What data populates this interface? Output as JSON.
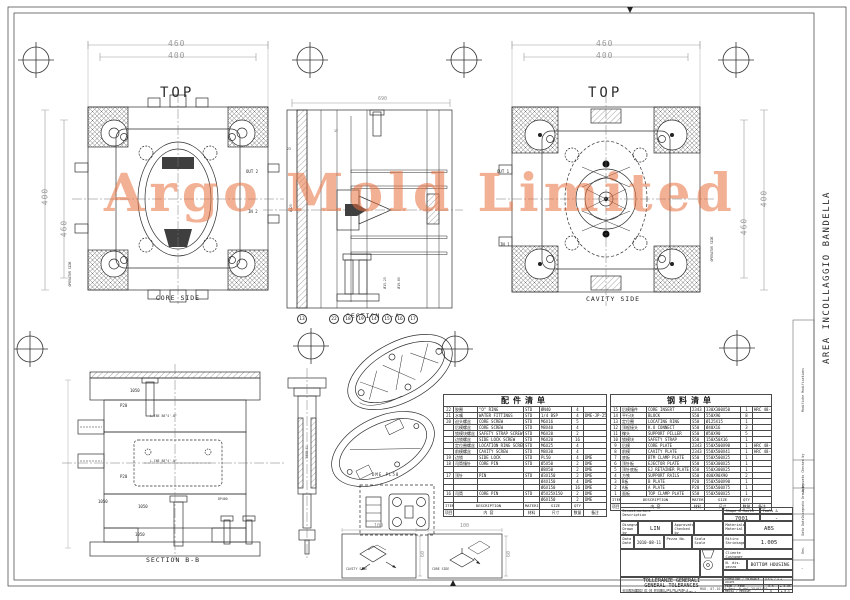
{
  "watermark": {
    "text": "Argo Mold Limited",
    "color": "#e8703f"
  },
  "sheet": {
    "side_note": "AREA INCOLLAGGIO BANDELLA",
    "registration_icon": "crosshair-target",
    "projection_icon": "first-angle-projection"
  },
  "views": {
    "core_top": {
      "title": "TOP",
      "caption": "CORE SIDE",
      "dim_top_outer": "460",
      "dim_top_inner": "400",
      "dim_left_outer": "400",
      "dim_left_inner": "460",
      "out_label": "OUT 2",
      "in_label": "IN 2",
      "operator": "OPERATOR SIDE"
    },
    "cavity_top": {
      "title": "TOP",
      "caption": "CAVITY SIDE",
      "dim_top_outer": "460",
      "dim_top_inner": "400",
      "dim_right_outer": "400",
      "dim_right_inner": "460",
      "out_label": "OUT 1",
      "in_label": "IN 1",
      "operator": "OPERATOR SIDE"
    },
    "section_a": {
      "caption": "SECTION A-A",
      "dim_top": "690",
      "dia_note_1": "Ø125",
      "dia_note_2": "Ø19.05",
      "dia_note_3": "Ø15.25",
      "dim_note_1": "23",
      "dim_note_2": "17",
      "balloons": [
        "13",
        "22",
        "18",
        "19",
        "14",
        "15",
        "16",
        "17"
      ]
    },
    "section_b": {
      "caption": "SECTION B-B",
      "plate_labels": [
        "1050",
        "P20",
        "P20",
        "1050",
        "1050",
        "1050"
      ],
      "line_note_1": "L.INE 88°4'-0°",
      "line_note_2": "L.INE 88°4'-0°",
      "bore_note": "DP400"
    },
    "sprue_detail": {
      "label": "5050-GL"
    },
    "latch_detail": {
      "caption": "DME PL50"
    },
    "runner_box_left": {
      "caption": "CAVITY SIDE",
      "dim_w": "100",
      "dim_h": "60"
    },
    "runner_box_right": {
      "caption": "CORE SIDE",
      "dim_w": "100",
      "dim_h": "60"
    }
  },
  "parts_table": {
    "title": "配件清单",
    "footer_en": [
      "ITEM",
      "DESCRIPTION",
      "MATERIAL",
      "SIZE",
      "QTY",
      ""
    ],
    "footer_cn": [
      "项目",
      "内 容",
      "材料",
      "尺寸",
      "数量",
      "备注"
    ],
    "rows": [
      {
        "item": "22",
        "cn": "胶圈",
        "desc": "\"O\" RING",
        "mat": "STD",
        "size": "ØN40",
        "qty": "4",
        "rk": ""
      },
      {
        "item": "21",
        "cn": "水嘴",
        "desc": "WATER FITTINGS",
        "mat": "STD",
        "size": "1/4 BSP",
        "qty": "4",
        "rk": "DME-JP-252"
      },
      {
        "item": "20",
        "cn": "迫头螺丝",
        "desc": "CORE SCREW",
        "mat": "STD",
        "size": "M6X16",
        "qty": "5",
        "rk": ""
      },
      {
        "item": "",
        "cn": "后模螺丝",
        "desc": "CORE SCREW",
        "mat": "STD",
        "size": "M8X40",
        "qty": "4",
        "rk": ""
      },
      {
        "item": "",
        "cn": "锁模块螺丝",
        "desc": "SAFETY STRAP SCREW",
        "mat": "STD",
        "size": "M6X20",
        "qty": "2",
        "rk": ""
      },
      {
        "item": "",
        "cn": "边锁螺丝",
        "desc": "SIDE LOCK SCREW",
        "mat": "STD",
        "size": "M6X20",
        "qty": "16",
        "rk": ""
      },
      {
        "item": "",
        "cn": "定位圈螺丝",
        "desc": "LOCATION RING SCREW",
        "mat": "STD",
        "size": "M6X25",
        "qty": "4",
        "rk": ""
      },
      {
        "item": "",
        "cn": "前模螺丝",
        "desc": "CAVITY SCREW",
        "mat": "STD",
        "size": "M8X30",
        "qty": "4",
        "rk": ""
      },
      {
        "item": "19",
        "cn": "边锁",
        "desc": "SIDE LOCK",
        "mat": "STD",
        "size": "PL50",
        "qty": "4",
        "rk": "DME"
      },
      {
        "item": "18",
        "cn": "司筒镶针",
        "desc": "CORE PIN",
        "mat": "STD",
        "size": "Ø5X50",
        "qty": "2",
        "rk": "DME"
      },
      {
        "item": "",
        "cn": "",
        "desc": "",
        "mat": "",
        "size": "Ø8X50",
        "qty": "2",
        "rk": "DME"
      },
      {
        "item": "17",
        "cn": "顶针",
        "desc": "PIN",
        "mat": "STD",
        "size": "Ø3X150",
        "qty": "2",
        "rk": "DME"
      },
      {
        "item": "",
        "cn": "",
        "desc": "",
        "mat": "",
        "size": "Ø4X150",
        "qty": "4",
        "rk": "DME"
      },
      {
        "item": "",
        "cn": "",
        "desc": "",
        "mat": "",
        "size": "Ø6X150",
        "qty": "16",
        "rk": "DME"
      },
      {
        "item": "16",
        "cn": "司筒",
        "desc": "CORE PIN",
        "mat": "STD",
        "size": "Ø5X25X150",
        "qty": "2",
        "rk": "DME"
      },
      {
        "item": "",
        "cn": "",
        "desc": "",
        "mat": "",
        "size": "Ø6X150",
        "qty": "2",
        "rk": "DME"
      }
    ]
  },
  "steel_table": {
    "title": "钢料清单",
    "footer_en": [
      "ITEM",
      "DESCRIPTION",
      "MATERIAL",
      "SIZE",
      "QTY",
      ""
    ],
    "footer_cn": [
      "项目",
      "内 容",
      "材料",
      "尺寸",
      "数量",
      "备注"
    ],
    "rows": [
      {
        "item": "15",
        "cn": "后模镶件",
        "desc": "CORE INSERT",
        "mat": "2343",
        "size": "330X300X50",
        "qty": "1",
        "rk": "HRC 48-52"
      },
      {
        "item": "14",
        "cn": "平行块",
        "desc": "BLOCK",
        "mat": "S50",
        "size": "550X96",
        "qty": "8",
        "rk": ""
      },
      {
        "item": "13",
        "cn": "定位圈",
        "desc": "LOCATING RING",
        "mat": "S50",
        "size": "Ø125X15",
        "qty": "1",
        "rk": ""
      },
      {
        "item": "12",
        "cn": "顶棍接头",
        "desc": "K.O CONNECT",
        "mat": "S50",
        "size": "Ø40X16",
        "qty": "3",
        "rk": ""
      },
      {
        "item": "11",
        "cn": "撑头",
        "desc": "SUPPORT PILLER",
        "mat": "S50",
        "size": "Ø50X90",
        "qty": "5",
        "rk": ""
      },
      {
        "item": "10",
        "cn": "锁模块",
        "desc": "SAFETY STRAP",
        "mat": "S50",
        "size": "150X50X16",
        "qty": "1",
        "rk": ""
      },
      {
        "item": "9",
        "cn": "后模",
        "desc": "CORE PLATE",
        "mat": "2343",
        "size": "550X500X90",
        "qty": "1",
        "rk": "HRC 48-52"
      },
      {
        "item": "8",
        "cn": "前模",
        "desc": "CAVITY PLATE",
        "mat": "2343",
        "size": "550X500X41",
        "qty": "1",
        "rk": "HRC 48-52"
      },
      {
        "item": "7",
        "cn": "底板",
        "desc": "BTM CLAMP PLATE",
        "mat": "S50",
        "size": "550X500X25",
        "qty": "1",
        "rk": ""
      },
      {
        "item": "6",
        "cn": "顶针板",
        "desc": "EJECTOR PLATE",
        "mat": "S50",
        "size": "550X300X25",
        "qty": "1",
        "rk": ""
      },
      {
        "item": "5",
        "cn": "顶针底板",
        "desc": "EJ RETAINER PLATE",
        "mat": "S50",
        "size": "550X300X25",
        "qty": "1",
        "rk": ""
      },
      {
        "item": "4",
        "cn": "方铁",
        "desc": "SUPPORT RAILS",
        "mat": "S50",
        "size": "400X90X90",
        "qty": "2",
        "rk": ""
      },
      {
        "item": "3",
        "cn": "B板",
        "desc": "B PLATE",
        "mat": "P20",
        "size": "550X500X90",
        "qty": "1",
        "rk": ""
      },
      {
        "item": "2",
        "cn": "A板",
        "desc": "A PLATE",
        "mat": "P20",
        "size": "550X500X75",
        "qty": "1",
        "rk": ""
      },
      {
        "item": "1",
        "cn": "面板",
        "desc": "TOP CLAMP PLATE",
        "mat": "S50",
        "size": "550X500X25",
        "qty": "1",
        "rk": ""
      }
    ]
  },
  "title_block": {
    "description_label": "Denominazione\nDescription",
    "shape_mould_label": "Shape & Mould No.",
    "shape_mould_value": "7001",
    "tools_mould_label": "Tools & Mould No.",
    "tools_mould_value": "-",
    "drawn_label": "Disegnato\nDrawn by",
    "drawn_value": "LIN",
    "approved_label": "Approvato\nChecked by",
    "approved_value": "",
    "date_label": "Data\nDate",
    "date_value": "2010-08-11",
    "piece_label": "Pezzo No.",
    "scale_label": "Scala\nScale",
    "material_label": "Materiale\nMaterial",
    "material_value": "ABS",
    "shrink_label": "Ritiro\nShrinkage",
    "shrink_value": "1.005",
    "customer_label": "Cliente\nCustomer",
    "customer_value": "",
    "partno_label": "N. dis. pezzo\nPart drw. No.",
    "partno_value": "BOTTOM HOUSING",
    "tol_title_it": "TOLLERANZE GENERALI",
    "tol_title_en": "GENERAL TOLERANCES",
    "tol_note_it": "ACCOPPIAMENTI H7-h6 SECONDO UNI EN 20286-2",
    "tol_note_en": "ACCOUPLEMENTS H7-h6 ACCORDING TO UNI EN 20286-2",
    "tol_header_dim": "DIMENSIONI / TOLERANCE VALUES",
    "tol_header_val": "oltre / a ±",
    "tol_rows": [
      {
        "g": "FINE / FINE",
        "a": "0.5",
        "b": "± 0.05"
      },
      {
        "g": "MEDIA / MEDIUM",
        "a": "6",
        "b": "± 0.1"
      },
      {
        "g": "GROSSA / LOW",
        "a": "30",
        "b": "± 0.5"
      }
    ],
    "footer": "MOD. 07.10.15   Rev. 0 del 25/01/10"
  },
  "revision_strip": {
    "labels": [
      "Modifiche\nModifications",
      "Approvato\nChecked by",
      "Disegnato\nDrawn by",
      "Data\nDate",
      "Rev."
    ],
    "value": "-"
  }
}
